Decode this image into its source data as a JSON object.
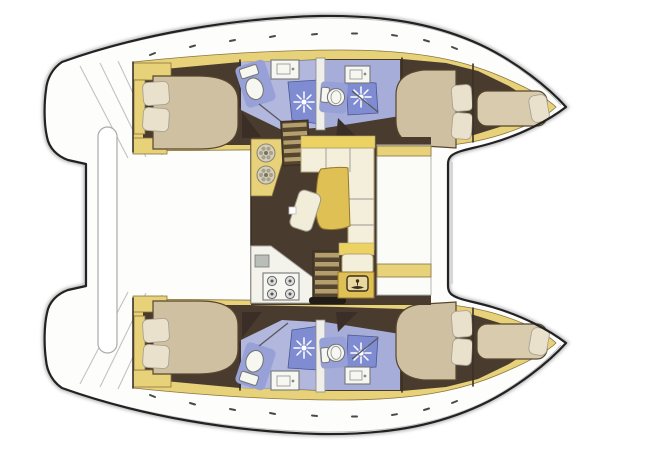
{
  "diagram": {
    "subject": "catamaran-interior-floor-plan",
    "view": "top-down",
    "orientation": "bows-to-the-right",
    "hull_count": 2
  },
  "rooms": {
    "port_hull": [
      "aft-double-cabin",
      "aft-head-with-shower",
      "forward-head-with-shower",
      "forward-double-cabin",
      "bow-berth"
    ],
    "starboard_hull": [
      "aft-double-cabin",
      "aft-head-with-shower",
      "forward-head-with-shower",
      "forward-double-cabin",
      "bow-berth"
    ],
    "bridgedeck_salon": [
      "galley-counter",
      "chart-area-panel",
      "l-shaped-settee",
      "dining-table",
      "kitchen-counter-with-stove",
      "companionway-stairs-port",
      "companionway-stairs-starboard"
    ]
  },
  "icons": [
    "shower-spray-icon",
    "toilet-icon",
    "washbasin-icon",
    "galley-sink-icon",
    "stove-burner-icon",
    "staircase-icon",
    "door-swing-icon",
    "lagoon-emblem-icon"
  ],
  "colors": {
    "hull_outline": "#222222",
    "hull_shadow": "#9e9e9e",
    "deck": "#fdfdfc",
    "deck_line": "#c2c2c2",
    "wall": "#3a3028",
    "wall_light": "#efeee8",
    "trim": "#e7d179",
    "trim_edge": "#8a7440",
    "floor": "#4a3b2d",
    "bed": "#cfc0a1",
    "bed_light": "#d8cbae",
    "bed_edge": "#57462f",
    "pillow": "#e9e1cb",
    "head_floor": "#b2b7dd",
    "head_floor_alt": "#a6add9",
    "shower": "#7f8cd2",
    "toilet_pad": "#97a1d8",
    "fixture": "#f7f7f2",
    "door_wedge": "#3a2f26",
    "table_gold": "#dfc055",
    "settee": "#f3efda",
    "settee_back": "#ecd264",
    "stair_dark": "#54452f",
    "stair_light": "#b49e6e",
    "stair_rail": "#241d17",
    "kitchen": "#f3f3ec",
    "appliance": "#b9beb9",
    "burner": "#dcdcdc",
    "emblem_bg": "#e8d9a0",
    "emblem_ink": "#3a2f1f",
    "bar": "#ffffff"
  }
}
